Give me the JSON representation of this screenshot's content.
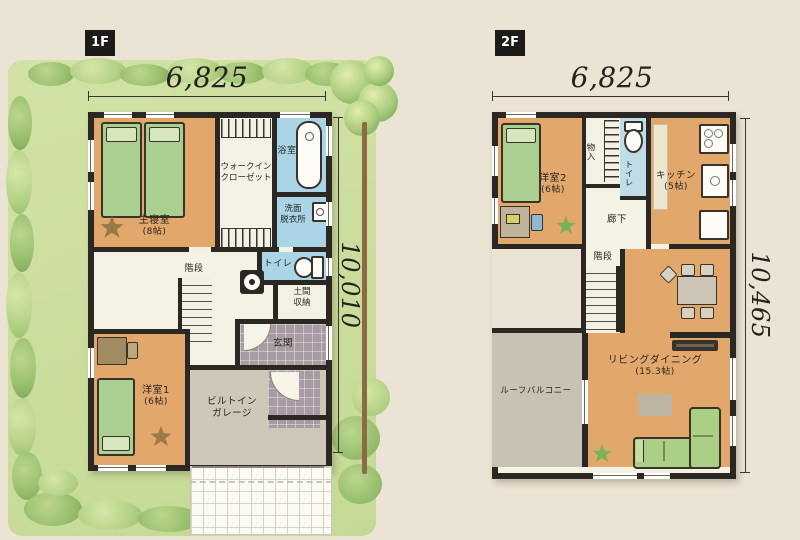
{
  "palette": {
    "background": "#EBE3D3",
    "wall": "#2B2722",
    "floor_wood": "#E2A76B",
    "wet_area_blue": "#A9D5E6",
    "bed_green": "#A9CF91",
    "entrance_tile": "#A89BA3",
    "garage_floor": "#CFC7B8",
    "balcony_gray": "#C8C1B4",
    "garden_green": "#CBDDA0",
    "sofa_green": "#ABCF84"
  },
  "floor1": {
    "tag": "1F",
    "dim_width": "6,825",
    "dim_height": "10,010",
    "rooms": {
      "master": {
        "name": "主寝室",
        "size": "(8帖)"
      },
      "wic": {
        "line1": "ウォークイン",
        "line2": "クローゼット"
      },
      "bath": {
        "name": "浴室"
      },
      "washroom": {
        "line1": "洗面",
        "line2": "脱衣所"
      },
      "toilet": {
        "name": "トイレ"
      },
      "stairs": {
        "name": "階段"
      },
      "doma": {
        "line1": "土間",
        "line2": "収納"
      },
      "entrance": {
        "name": "玄関"
      },
      "western1": {
        "name": "洋室1",
        "size": "(6帖)"
      },
      "garage": {
        "line1": "ビルトイン",
        "line2": "ガレージ"
      }
    }
  },
  "floor2": {
    "tag": "2F",
    "dim_width": "6,825",
    "dim_height": "10,465",
    "rooms": {
      "western2": {
        "name": "洋室2",
        "size": "(6帖)"
      },
      "closet": {
        "name": "物入"
      },
      "toilet": {
        "name": "トイレ"
      },
      "kitchen": {
        "name": "キッチン",
        "size": "(5帖)"
      },
      "hallway": {
        "name": "廊下"
      },
      "stairs": {
        "name": "階段"
      },
      "living": {
        "name": "リビングダイニング",
        "size": "(15.3帖)"
      },
      "balcony": {
        "name": "ルーフバルコニー"
      }
    }
  }
}
